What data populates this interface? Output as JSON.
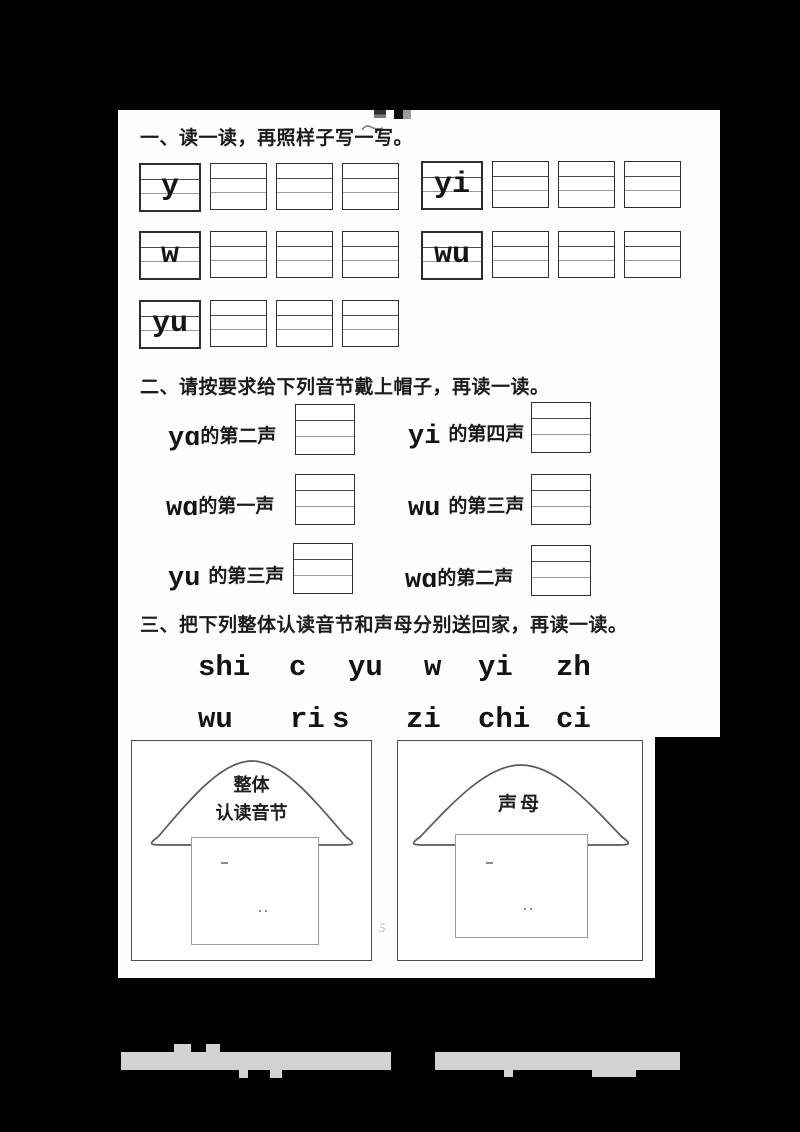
{
  "page": {
    "page_number": "5",
    "background_color": "#000000",
    "paper_color": "#fefefe",
    "ink_color": "#1b1b1b",
    "watermark_bar_color": "#d2d2d2"
  },
  "section1": {
    "heading": "一、读一读，再照样子写一写。",
    "groups": [
      {
        "example": "y"
      },
      {
        "example": "yi"
      },
      {
        "example": "w"
      },
      {
        "example": "wu"
      },
      {
        "example": "yu"
      }
    ],
    "blanks_per_group": 3
  },
  "section2": {
    "heading": "二、请按要求给下列音节戴上帽子，再读一读。",
    "items": [
      {
        "syllable": "yɑ",
        "task": "的第二声"
      },
      {
        "syllable": "yi",
        "task": "的第四声"
      },
      {
        "syllable": "wɑ",
        "task": "的第一声"
      },
      {
        "syllable": "wu",
        "task": "的第三声"
      },
      {
        "syllable": "yu",
        "task": "的第三声"
      },
      {
        "syllable": "wɑ",
        "task": "的第二声"
      }
    ]
  },
  "section3": {
    "heading": "三、把下列整体认读音节和声母分别送回家，再读一读。",
    "syllables_row1": [
      "shi",
      "c",
      "yu",
      "w",
      "yi",
      "zh"
    ],
    "syllables_row2": [
      "wu",
      "ri",
      "s",
      "zi",
      "chi",
      "ci"
    ],
    "houses": [
      {
        "title_line1": "整体",
        "title_line2": "认读音节"
      },
      {
        "title_line1": "声母",
        "title_line2": ""
      }
    ]
  }
}
